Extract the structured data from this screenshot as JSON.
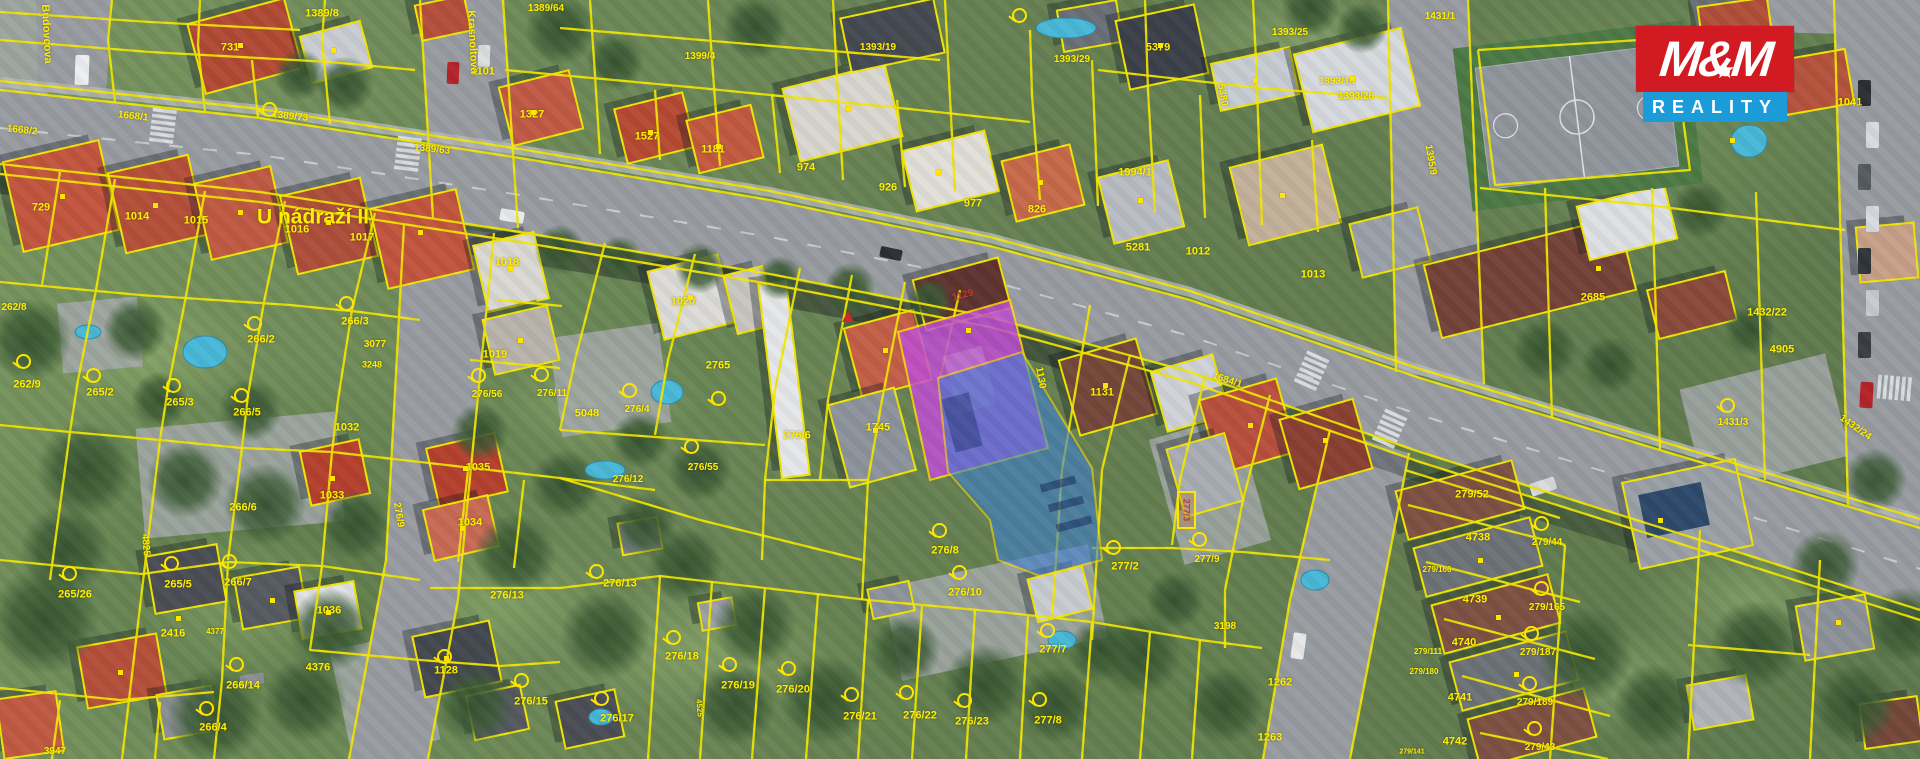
{
  "map": {
    "logo": {
      "top": "M&M",
      "bottom": "REALITY",
      "red": "#d11a21",
      "blue": "#1b9cd8"
    },
    "colors": {
      "parcel_line": "#f2e600",
      "label": "#ffee00",
      "building_highlight": "#c14fd6",
      "area_highlight": "#3d7fd2"
    },
    "street_names": [
      {
        "t": "U nádraží II",
        "x": 313,
        "y": 217,
        "s": 21,
        "r": 0
      },
      {
        "t": "Krasnoltova",
        "x": 472,
        "y": 42,
        "s": 11,
        "r": 87
      },
      {
        "t": "Budovcova",
        "x": 46,
        "y": 34,
        "s": 11,
        "r": 87
      }
    ],
    "special_labels": [
      {
        "t": "277/3",
        "x": 1186,
        "y": 510
      }
    ],
    "parcel_labels": [
      {
        "t": "1389/8",
        "x": 322,
        "y": 14
      },
      {
        "t": "731",
        "x": 230,
        "y": 48
      },
      {
        "t": "1101",
        "x": 483,
        "y": 72
      },
      {
        "t": "1389/73",
        "x": 290,
        "y": 117,
        "s": 10,
        "r": 6
      },
      {
        "t": "1389/63",
        "x": 432,
        "y": 150,
        "s": 10,
        "r": 6
      },
      {
        "t": "1389/64",
        "x": 546,
        "y": 9,
        "s": 10
      },
      {
        "t": "1327",
        "x": 532,
        "y": 115
      },
      {
        "t": "1527",
        "x": 647,
        "y": 137
      },
      {
        "t": "1181",
        "x": 713,
        "y": 150
      },
      {
        "t": "1399/4",
        "x": 700,
        "y": 57,
        "s": 10
      },
      {
        "t": "974",
        "x": 806,
        "y": 168
      },
      {
        "t": "926",
        "x": 888,
        "y": 188
      },
      {
        "t": "977",
        "x": 973,
        "y": 204
      },
      {
        "t": "1393/19",
        "x": 878,
        "y": 48,
        "s": 10
      },
      {
        "t": "1393/29",
        "x": 1072,
        "y": 60,
        "s": 10
      },
      {
        "t": "5379",
        "x": 1158,
        "y": 48
      },
      {
        "t": "1393/25",
        "x": 1290,
        "y": 33,
        "s": 10
      },
      {
        "t": "1393/14",
        "x": 1337,
        "y": 82,
        "s": 10
      },
      {
        "t": "1393/26",
        "x": 1356,
        "y": 97,
        "s": 10
      },
      {
        "t": "5380",
        "x": 1222,
        "y": 95,
        "r": 80,
        "s": 10
      },
      {
        "t": "826",
        "x": 1037,
        "y": 210
      },
      {
        "t": "1994/1",
        "x": 1135,
        "y": 173
      },
      {
        "t": "5281",
        "x": 1138,
        "y": 248
      },
      {
        "t": "1012",
        "x": 1198,
        "y": 252
      },
      {
        "t": "1013",
        "x": 1313,
        "y": 275
      },
      {
        "t": "1431/1",
        "x": 1440,
        "y": 17,
        "s": 10
      },
      {
        "t": "1041",
        "x": 1850,
        "y": 103
      },
      {
        "t": "1395/9",
        "x": 1430,
        "y": 160,
        "r": 80,
        "s": 10
      },
      {
        "t": "2685",
        "x": 1593,
        "y": 298
      },
      {
        "t": "1432/22",
        "x": 1767,
        "y": 313
      },
      {
        "t": "4905",
        "x": 1782,
        "y": 350
      },
      {
        "t": "1431/3",
        "x": 1733,
        "y": 423,
        "s": 10
      },
      {
        "t": "1432/24",
        "x": 1855,
        "y": 428,
        "s": 10,
        "r": 35
      },
      {
        "t": "1668/2",
        "x": 22,
        "y": 131,
        "s": 10,
        "r": 6
      },
      {
        "t": "1668/1",
        "x": 133,
        "y": 117,
        "s": 10,
        "r": 6
      },
      {
        "t": "1684/1",
        "x": 1227,
        "y": 381,
        "s": 10,
        "r": 18
      },
      {
        "t": "729",
        "x": 41,
        "y": 208
      },
      {
        "t": "1014",
        "x": 137,
        "y": 217
      },
      {
        "t": "1015",
        "x": 196,
        "y": 221
      },
      {
        "t": "1016",
        "x": 297,
        "y": 230
      },
      {
        "t": "1017",
        "x": 362,
        "y": 238
      },
      {
        "t": "262/8",
        "x": 14,
        "y": 308,
        "s": 10
      },
      {
        "t": "262/9",
        "x": 27,
        "y": 385
      },
      {
        "t": "265/2",
        "x": 100,
        "y": 393
      },
      {
        "t": "265/3",
        "x": 180,
        "y": 403
      },
      {
        "t": "266/5",
        "x": 247,
        "y": 413
      },
      {
        "t": "266/2",
        "x": 261,
        "y": 340
      },
      {
        "t": "266/3",
        "x": 355,
        "y": 322
      },
      {
        "t": "3077",
        "x": 375,
        "y": 345,
        "s": 10
      },
      {
        "t": "3248",
        "x": 372,
        "y": 365,
        "s": 9
      },
      {
        "t": "1032",
        "x": 347,
        "y": 428
      },
      {
        "t": "1018",
        "x": 507,
        "y": 263
      },
      {
        "t": "1019",
        "x": 495,
        "y": 355
      },
      {
        "t": "1020",
        "x": 683,
        "y": 302
      },
      {
        "t": "2765",
        "x": 718,
        "y": 366
      },
      {
        "t": "265/26",
        "x": 75,
        "y": 595
      },
      {
        "t": "4825",
        "x": 145,
        "y": 545,
        "r": 85,
        "s": 10
      },
      {
        "t": "265/5",
        "x": 178,
        "y": 585
      },
      {
        "t": "266/7",
        "x": 238,
        "y": 583
      },
      {
        "t": "266/6",
        "x": 243,
        "y": 508
      },
      {
        "t": "1033",
        "x": 332,
        "y": 496
      },
      {
        "t": "1034",
        "x": 470,
        "y": 523
      },
      {
        "t": "1035",
        "x": 478,
        "y": 468
      },
      {
        "t": "1036",
        "x": 329,
        "y": 611
      },
      {
        "t": "2416",
        "x": 173,
        "y": 634
      },
      {
        "t": "4377",
        "x": 215,
        "y": 632,
        "s": 8
      },
      {
        "t": "266/14",
        "x": 243,
        "y": 686
      },
      {
        "t": "4376",
        "x": 318,
        "y": 668
      },
      {
        "t": "266/4",
        "x": 213,
        "y": 728
      },
      {
        "t": "3947",
        "x": 55,
        "y": 752,
        "s": 10
      },
      {
        "t": "1128",
        "x": 446,
        "y": 671
      },
      {
        "t": "276/15",
        "x": 531,
        "y": 702
      },
      {
        "t": "276/17",
        "x": 617,
        "y": 719
      },
      {
        "t": "276/13",
        "x": 507,
        "y": 596
      },
      {
        "t": "276/13",
        "x": 620,
        "y": 584
      },
      {
        "t": "276/56",
        "x": 487,
        "y": 395,
        "s": 10
      },
      {
        "t": "276/11",
        "x": 552,
        "y": 394,
        "s": 10
      },
      {
        "t": "5048",
        "x": 587,
        "y": 414
      },
      {
        "t": "276/4",
        "x": 637,
        "y": 410,
        "s": 10
      },
      {
        "t": "276/12",
        "x": 628,
        "y": 480,
        "s": 10
      },
      {
        "t": "276/55",
        "x": 703,
        "y": 468,
        "s": 10
      },
      {
        "t": "276/9",
        "x": 398,
        "y": 515,
        "r": 80,
        "s": 10
      },
      {
        "t": "276/6",
        "x": 797,
        "y": 436
      },
      {
        "t": "1745",
        "x": 878,
        "y": 428
      },
      {
        "t": "1129",
        "x": 963,
        "y": 296,
        "s": 10,
        "r": -15,
        "c": "#c03a34"
      },
      {
        "t": "1130",
        "x": 1040,
        "y": 378,
        "r": 80,
        "s": 10
      },
      {
        "t": "1131",
        "x": 1102,
        "y": 393
      },
      {
        "t": "277/9",
        "x": 1207,
        "y": 560,
        "s": 10
      },
      {
        "t": "277/2",
        "x": 1125,
        "y": 567
      },
      {
        "t": "276/8",
        "x": 945,
        "y": 551
      },
      {
        "t": "276/10",
        "x": 965,
        "y": 593
      },
      {
        "t": "276/18",
        "x": 682,
        "y": 657
      },
      {
        "t": "276/19",
        "x": 738,
        "y": 686
      },
      {
        "t": "276/20",
        "x": 793,
        "y": 690
      },
      {
        "t": "276/21",
        "x": 860,
        "y": 717
      },
      {
        "t": "276/22",
        "x": 920,
        "y": 716
      },
      {
        "t": "276/23",
        "x": 972,
        "y": 722
      },
      {
        "t": "277/8",
        "x": 1048,
        "y": 721
      },
      {
        "t": "277/7",
        "x": 1053,
        "y": 650
      },
      {
        "t": "4525",
        "x": 699,
        "y": 708,
        "r": 85,
        "s": 8
      },
      {
        "t": "3198",
        "x": 1225,
        "y": 627,
        "s": 10
      },
      {
        "t": "1262",
        "x": 1280,
        "y": 683
      },
      {
        "t": "1263",
        "x": 1270,
        "y": 738
      },
      {
        "t": "279/52",
        "x": 1472,
        "y": 495
      },
      {
        "t": "4738",
        "x": 1478,
        "y": 538
      },
      {
        "t": "279/166",
        "x": 1437,
        "y": 570,
        "s": 8
      },
      {
        "t": "4739",
        "x": 1475,
        "y": 600
      },
      {
        "t": "279/165",
        "x": 1547,
        "y": 608,
        "s": 10
      },
      {
        "t": "4740",
        "x": 1464,
        "y": 643
      },
      {
        "t": "279/111",
        "x": 1428,
        "y": 652,
        "s": 8
      },
      {
        "t": "279/187",
        "x": 1538,
        "y": 653,
        "s": 10
      },
      {
        "t": "279/180",
        "x": 1424,
        "y": 672,
        "s": 8
      },
      {
        "t": "4741",
        "x": 1460,
        "y": 698
      },
      {
        "t": "279/189",
        "x": 1535,
        "y": 703,
        "s": 10
      },
      {
        "t": "4742",
        "x": 1455,
        "y": 742
      },
      {
        "t": "279/43",
        "x": 1540,
        "y": 748,
        "s": 10
      },
      {
        "t": "279/141",
        "x": 1412,
        "y": 752,
        "s": 7
      },
      {
        "t": "279/44",
        "x": 1547,
        "y": 543,
        "s": 10
      }
    ],
    "markers": {
      "dots": [
        [
          240,
          45
        ],
        [
          333,
          50
        ],
        [
          533,
          112
        ],
        [
          650,
          132
        ],
        [
          718,
          146
        ],
        [
          848,
          108
        ],
        [
          938,
          172
        ],
        [
          1160,
          45
        ],
        [
          1255,
          80
        ],
        [
          1352,
          78
        ],
        [
          1282,
          195
        ],
        [
          1140,
          200
        ],
        [
          1040,
          182
        ],
        [
          1598,
          268
        ],
        [
          62,
          196
        ],
        [
          155,
          205
        ],
        [
          240,
          212
        ],
        [
          328,
          222
        ],
        [
          420,
          232
        ],
        [
          510,
          268
        ],
        [
          520,
          340
        ],
        [
          690,
          297
        ],
        [
          885,
          350
        ],
        [
          968,
          330
        ],
        [
          1105,
          385
        ],
        [
          1250,
          425
        ],
        [
          1325,
          440
        ],
        [
          332,
          478
        ],
        [
          465,
          468
        ],
        [
          462,
          528
        ],
        [
          328,
          612
        ],
        [
          446,
          658
        ],
        [
          178,
          618
        ],
        [
          272,
          600
        ],
        [
          120,
          672
        ],
        [
          1480,
          560
        ],
        [
          1498,
          617
        ],
        [
          1516,
          674
        ],
        [
          1660,
          520
        ],
        [
          1838,
          622
        ],
        [
          875,
          430
        ],
        [
          1732,
          140
        ]
      ],
      "circle_icons": [
        [
          253,
          322
        ],
        [
          345,
          302
        ],
        [
          92,
          374
        ],
        [
          172,
          384
        ],
        [
          240,
          394
        ],
        [
          68,
          572
        ],
        [
          170,
          562
        ],
        [
          228,
          560
        ],
        [
          235,
          663
        ],
        [
          205,
          707
        ],
        [
          595,
          570
        ],
        [
          672,
          636
        ],
        [
          728,
          663
        ],
        [
          787,
          667
        ],
        [
          850,
          693
        ],
        [
          905,
          691
        ],
        [
          963,
          699
        ],
        [
          1038,
          698
        ],
        [
          1046,
          629
        ],
        [
          958,
          571
        ],
        [
          938,
          529
        ],
        [
          600,
          697
        ],
        [
          520,
          679
        ],
        [
          477,
          374
        ],
        [
          540,
          373
        ],
        [
          628,
          389
        ],
        [
          717,
          397
        ],
        [
          690,
          445
        ],
        [
          1112,
          546
        ],
        [
          1198,
          538
        ],
        [
          1540,
          522
        ],
        [
          1540,
          587
        ],
        [
          1530,
          632
        ],
        [
          1528,
          682
        ],
        [
          1533,
          727
        ],
        [
          1726,
          404
        ],
        [
          443,
          655
        ],
        [
          268,
          108
        ],
        [
          22,
          360
        ],
        [
          1018,
          14
        ]
      ],
      "triangles": [
        [
          848,
          317
        ]
      ]
    }
  }
}
